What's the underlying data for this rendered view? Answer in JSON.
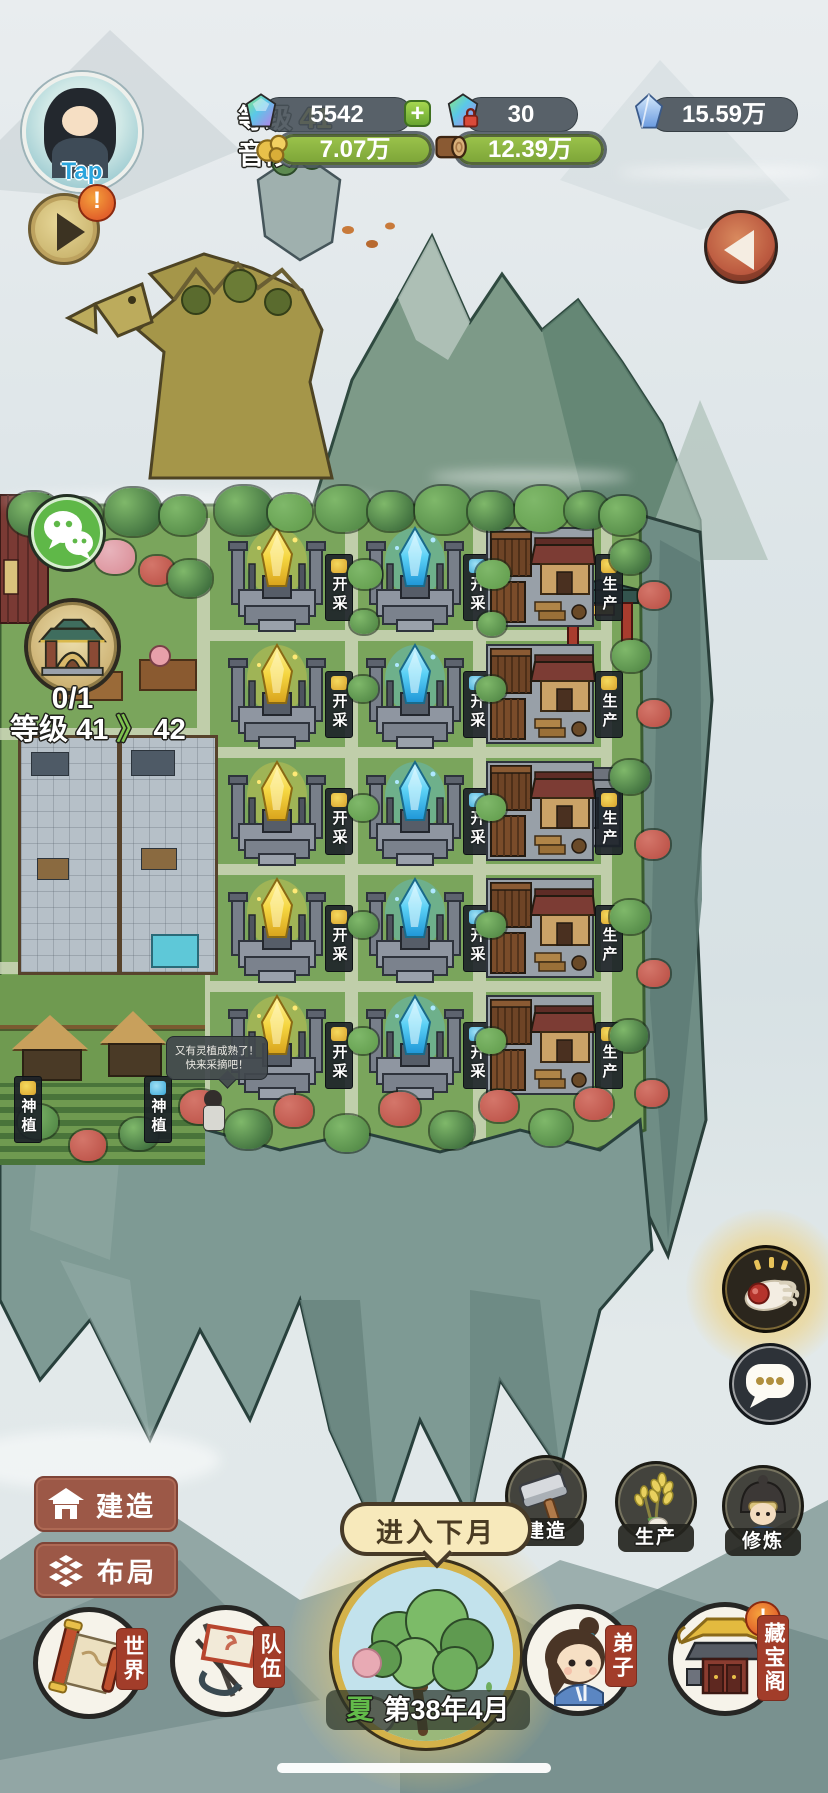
{
  "header": {
    "tap_label": "Tap",
    "level_label": "等级",
    "level_value": "41",
    "player_name": "音段",
    "plus_label": "+",
    "resources": {
      "gems": "5542",
      "locked_gems": "30",
      "crystal": "15.59万",
      "gold_ore": "7.07万",
      "wood": "12.39万"
    }
  },
  "left_hud": {
    "shrine_progress": "0/1",
    "level_label": "等级",
    "level_from": "41",
    "level_arrow": "》",
    "level_to": "42"
  },
  "map": {
    "mine_label": "开采",
    "produce_label": "生产",
    "plant_label": "神植",
    "npc_bubble": {
      "line1": "又有灵植成熟了！",
      "line2": "快来采摘吧！"
    }
  },
  "side_menu": {
    "build": "建造",
    "layout": "布局"
  },
  "actions": {
    "build": "建造",
    "produce": "生产",
    "cultivate": "修炼"
  },
  "next_month_label": "进入下月",
  "footer": {
    "nav": [
      {
        "label": "世界"
      },
      {
        "label": "队伍"
      },
      {
        "label": "弟子"
      },
      {
        "label": "藏宝阁"
      }
    ],
    "season": "夏",
    "date": "第38年4月"
  },
  "badges": {
    "alert": "!"
  }
}
